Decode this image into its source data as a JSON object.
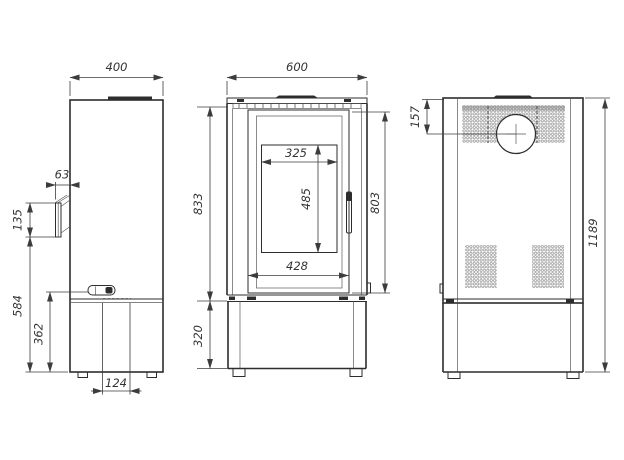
{
  "colors": {
    "background": "#ffffff",
    "object_line": "#2d2d2d",
    "dimension_line": "#3c3c3c",
    "perforation": "#8f8f8f"
  },
  "dims": {
    "side": {
      "top_width": "400",
      "flue_offset": "63",
      "bracket_height": "135",
      "lower_height": "584",
      "handle_height": "362",
      "drawer_width": "124"
    },
    "front": {
      "top_width": "600",
      "body_height": "833",
      "door_height": "803",
      "glass_width": "325",
      "glass_height": "485",
      "door_width": "428",
      "base_height": "320"
    },
    "back": {
      "flue_center_from_top": "157",
      "total_height": "1189"
    }
  }
}
